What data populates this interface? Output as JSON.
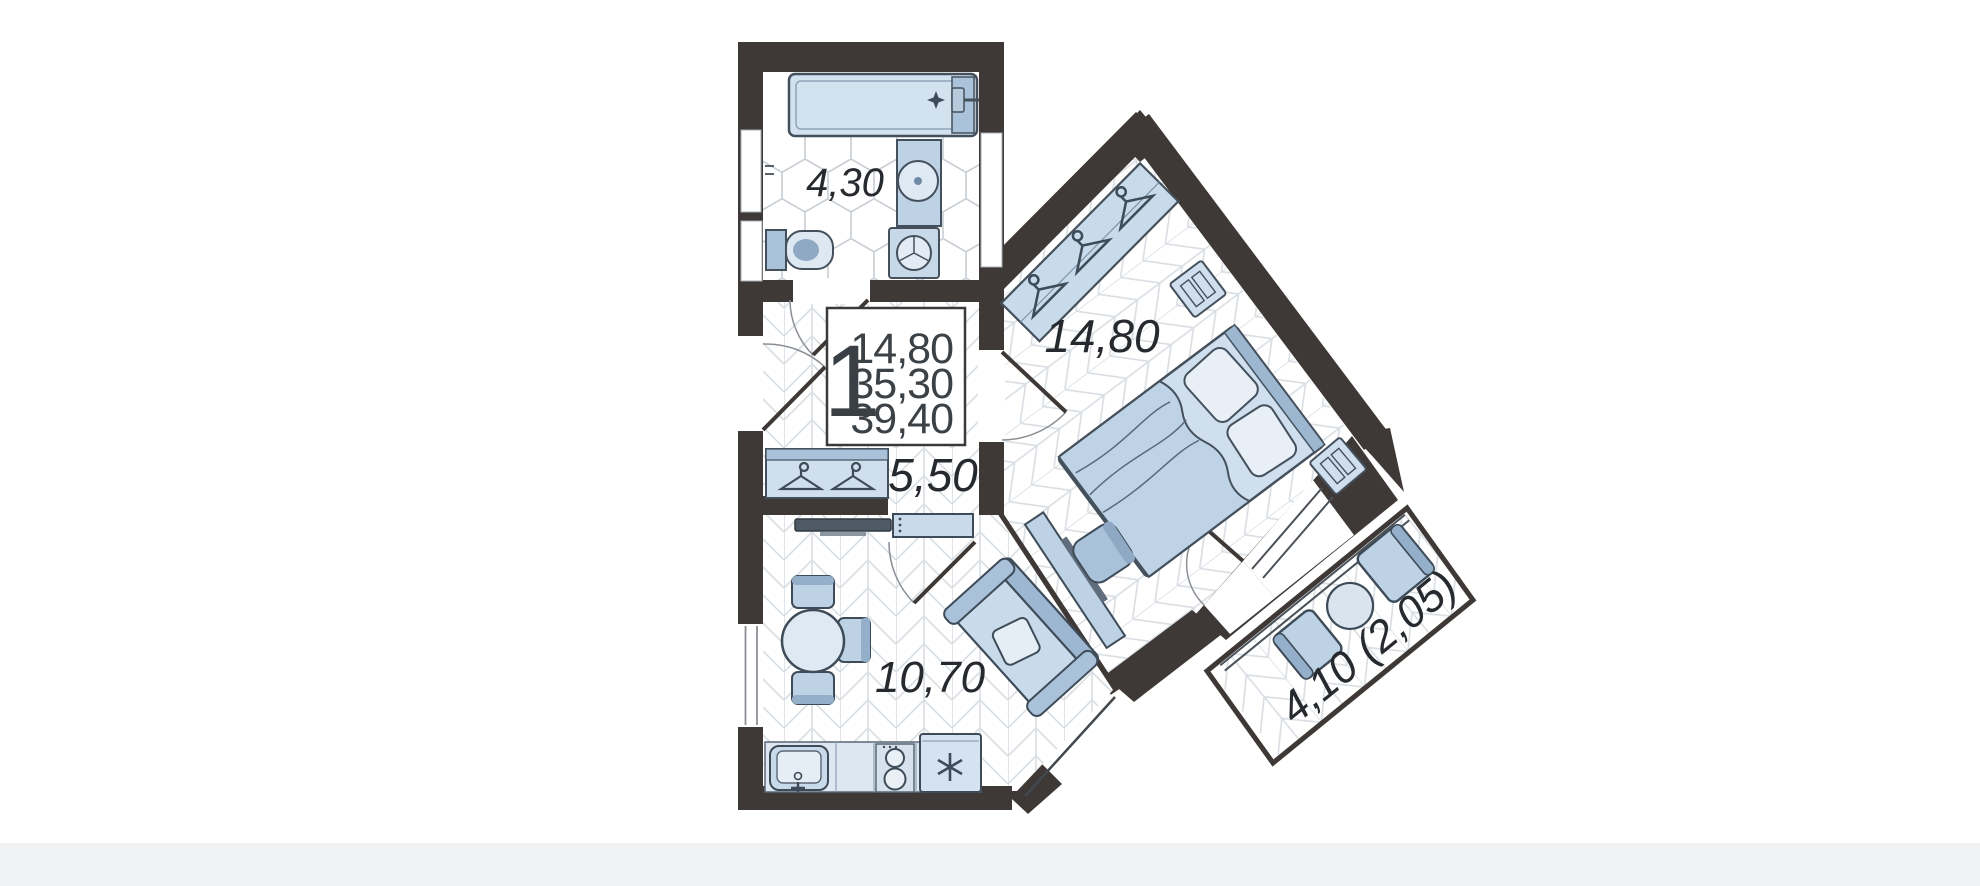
{
  "plan": {
    "type": "apartment-floor-plan",
    "unit_badge": {
      "rooms_count": "1",
      "living_area": "14,80",
      "apartment_area": "35,30",
      "total_area": "39,40"
    },
    "rooms": {
      "bathroom": {
        "name": "bathroom",
        "area": "4,30"
      },
      "hallway": {
        "name": "hallway",
        "area": "5,50"
      },
      "living_kitchen": {
        "name": "living-kitchen",
        "area": "10,70"
      },
      "bedroom": {
        "name": "bedroom",
        "area": "14,80"
      },
      "balcony": {
        "name": "balcony",
        "area": "4,10 (2,05)"
      }
    },
    "colors": {
      "wall": "#3E3936",
      "furniture_light": "#D5E2EF",
      "furniture_mid": "#BDD2E5",
      "furniture_dark": "#9DB7D1",
      "furniture_outline": "#3E4B58",
      "floor_line": "#DADFE4",
      "label_text": "#26292D"
    }
  }
}
